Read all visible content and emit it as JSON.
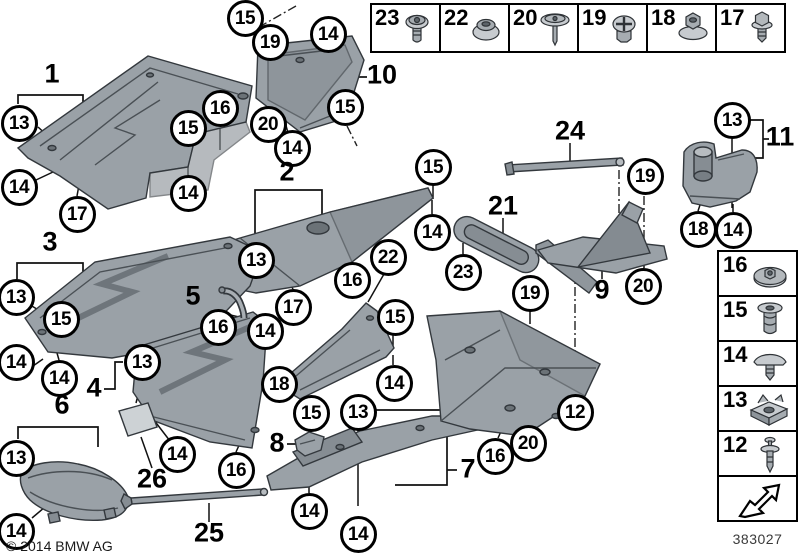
{
  "diagram": {
    "kind": "underbody-panelling-parts-diagram",
    "footer": {
      "copyright": "© 2014 BMW AG",
      "catalog_number": "383027"
    }
  },
  "legend_top": {
    "items": [
      {
        "number": "23",
        "icon": "torx-screw"
      },
      {
        "number": "22",
        "icon": "plastic-nut"
      },
      {
        "number": "20",
        "icon": "washer-head-screw"
      },
      {
        "number": "19",
        "icon": "expanding-rivet"
      },
      {
        "number": "18",
        "icon": "flange-nut"
      },
      {
        "number": "17",
        "icon": "hex-bolt"
      }
    ]
  },
  "legend_right": {
    "items": [
      {
        "number": "16",
        "icon": "washer-nut"
      },
      {
        "number": "15",
        "icon": "blind-rivet"
      },
      {
        "number": "14",
        "icon": "umbrella-clip"
      },
      {
        "number": "13",
        "icon": "cage-nut"
      },
      {
        "number": "12",
        "icon": "push-rivet"
      }
    ],
    "arrow_icon": "direction-arrow"
  },
  "callouts": [
    {
      "n": "15",
      "x": 245,
      "y": 18
    },
    {
      "n": "19",
      "x": 270,
      "y": 42
    },
    {
      "n": "14",
      "x": 328,
      "y": 34
    },
    {
      "n": "13",
      "x": 19,
      "y": 123
    },
    {
      "n": "14",
      "x": 19,
      "y": 187
    },
    {
      "n": "17",
      "x": 77,
      "y": 214
    },
    {
      "n": "16",
      "x": 220,
      "y": 108
    },
    {
      "n": "15",
      "x": 188,
      "y": 128
    },
    {
      "n": "14",
      "x": 188,
      "y": 193
    },
    {
      "n": "15",
      "x": 345,
      "y": 107
    },
    {
      "n": "20",
      "x": 268,
      "y": 124
    },
    {
      "n": "14",
      "x": 292,
      "y": 148
    },
    {
      "n": "13",
      "x": 732,
      "y": 120
    },
    {
      "n": "18",
      "x": 698,
      "y": 229
    },
    {
      "n": "14",
      "x": 733,
      "y": 230
    },
    {
      "n": "13",
      "x": 256,
      "y": 260
    },
    {
      "n": "17",
      "x": 293,
      "y": 307
    },
    {
      "n": "16",
      "x": 352,
      "y": 280
    },
    {
      "n": "22",
      "x": 388,
      "y": 257
    },
    {
      "n": "14",
      "x": 432,
      "y": 232
    },
    {
      "n": "15",
      "x": 433,
      "y": 167
    },
    {
      "n": "14",
      "x": 265,
      "y": 331
    },
    {
      "n": "16",
      "x": 218,
      "y": 327
    },
    {
      "n": "23",
      "x": 463,
      "y": 272
    },
    {
      "n": "19",
      "x": 645,
      "y": 176
    },
    {
      "n": "20",
      "x": 643,
      "y": 286
    },
    {
      "n": "19",
      "x": 530,
      "y": 293
    },
    {
      "n": "15",
      "x": 395,
      "y": 317
    },
    {
      "n": "14",
      "x": 394,
      "y": 383
    },
    {
      "n": "13",
      "x": 16,
      "y": 297
    },
    {
      "n": "15",
      "x": 61,
      "y": 319
    },
    {
      "n": "14",
      "x": 16,
      "y": 362
    },
    {
      "n": "14",
      "x": 59,
      "y": 378
    },
    {
      "n": "13",
      "x": 142,
      "y": 362
    },
    {
      "n": "13",
      "x": 16,
      "y": 458
    },
    {
      "n": "14",
      "x": 16,
      "y": 531
    },
    {
      "n": "14",
      "x": 177,
      "y": 454
    },
    {
      "n": "16",
      "x": 236,
      "y": 470
    },
    {
      "n": "18",
      "x": 279,
      "y": 384
    },
    {
      "n": "15",
      "x": 311,
      "y": 413
    },
    {
      "n": "13",
      "x": 358,
      "y": 412
    },
    {
      "n": "14",
      "x": 309,
      "y": 511
    },
    {
      "n": "14",
      "x": 358,
      "y": 534
    },
    {
      "n": "16",
      "x": 495,
      "y": 456
    },
    {
      "n": "20",
      "x": 528,
      "y": 443
    },
    {
      "n": "12",
      "x": 575,
      "y": 412
    }
  ],
  "labels": [
    {
      "n": "1",
      "x": 52,
      "y": 74
    },
    {
      "n": "2",
      "x": 287,
      "y": 172
    },
    {
      "n": "3",
      "x": 50,
      "y": 242
    },
    {
      "n": "4",
      "x": 94,
      "y": 388
    },
    {
      "n": "5",
      "x": 193,
      "y": 296
    },
    {
      "n": "6",
      "x": 62,
      "y": 405
    },
    {
      "n": "7",
      "x": 468,
      "y": 469
    },
    {
      "n": "8",
      "x": 277,
      "y": 443
    },
    {
      "n": "9",
      "x": 602,
      "y": 290
    },
    {
      "n": "10",
      "x": 382,
      "y": 75
    },
    {
      "n": "11",
      "x": 780,
      "y": 137
    },
    {
      "n": "21",
      "x": 503,
      "y": 206
    },
    {
      "n": "24",
      "x": 570,
      "y": 131
    },
    {
      "n": "25",
      "x": 209,
      "y": 533
    },
    {
      "n": "26",
      "x": 152,
      "y": 479
    }
  ]
}
